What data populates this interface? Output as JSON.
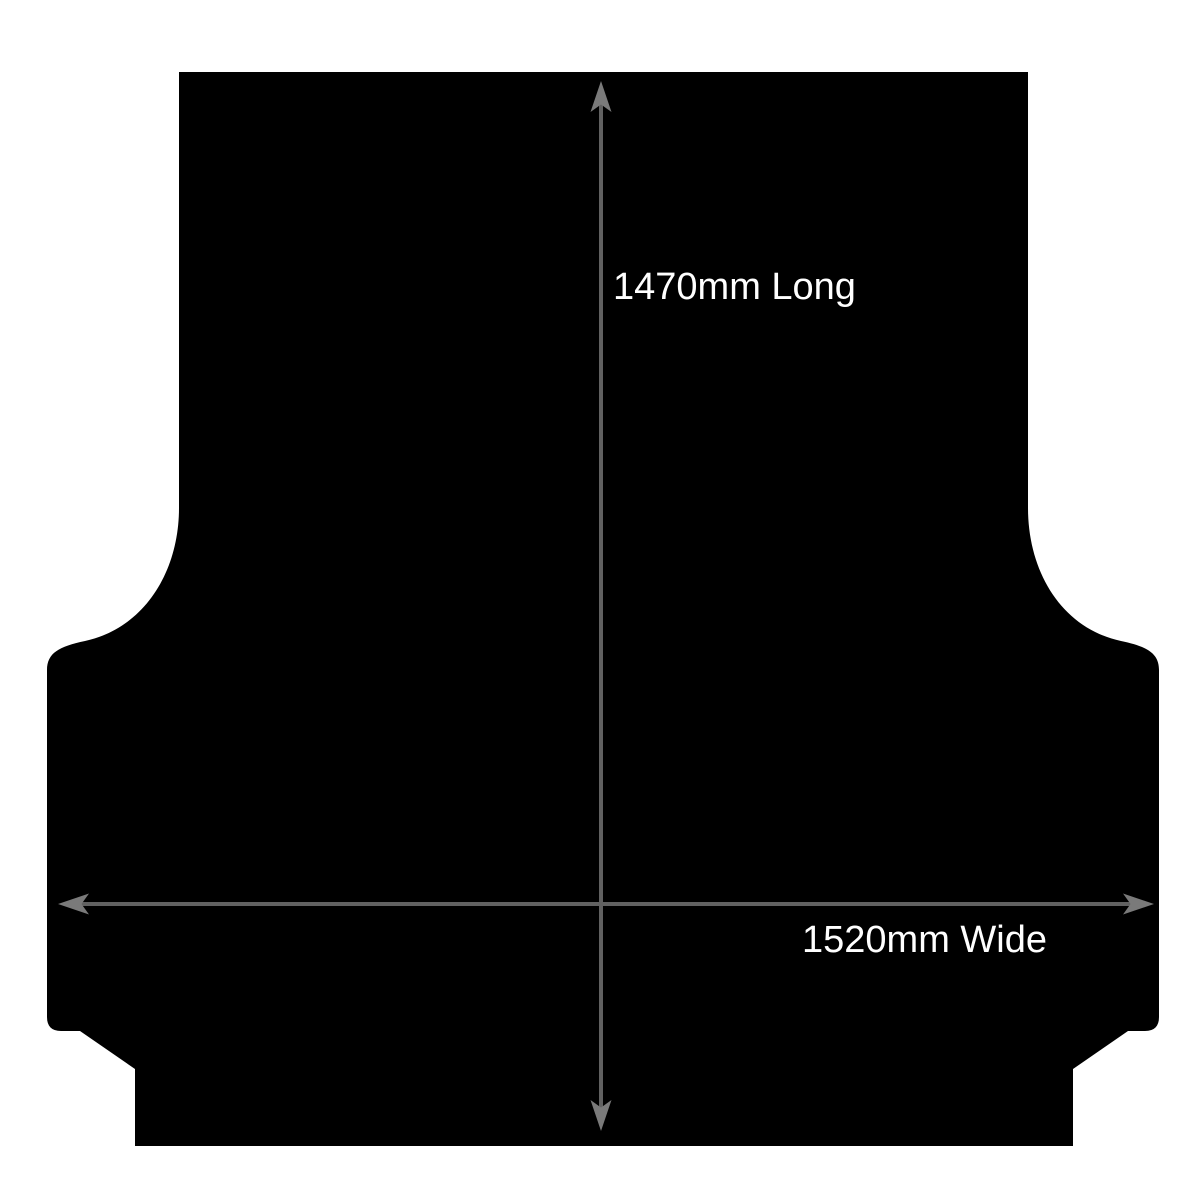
{
  "diagram": {
    "labels": {
      "length": "1470mm Long",
      "width": "1520mm Wide"
    },
    "measurements": {
      "length_mm": 1470,
      "width_mm": 1520
    },
    "colors": {
      "background": "#ffffff",
      "mat": "#000000",
      "arrow_line": "#616161",
      "arrow_head": "#7a7a7a",
      "label_text": "#ffffff"
    }
  }
}
